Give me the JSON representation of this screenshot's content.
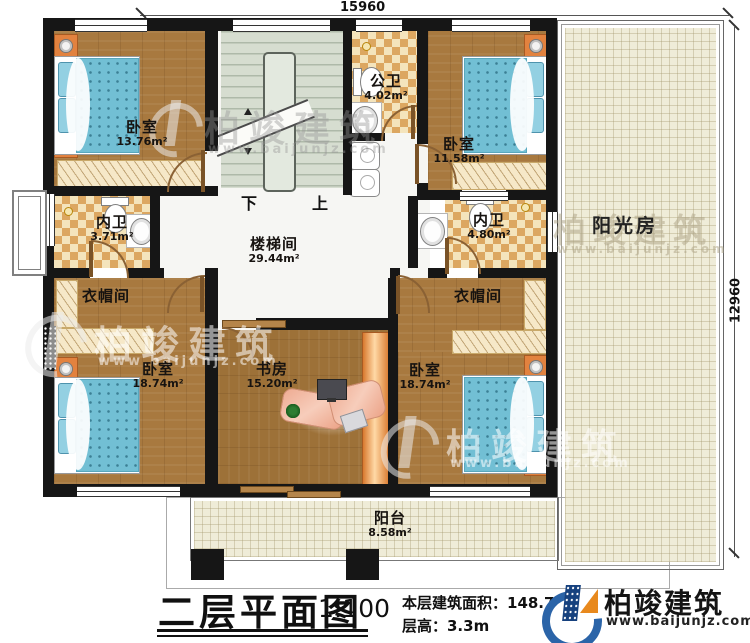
{
  "dimensions": {
    "width": "15960",
    "height": "12960"
  },
  "rooms": {
    "bedroom_tl": {
      "name": "卧室",
      "area": "13.76m²"
    },
    "stairwell": {
      "name": "楼梯间",
      "area": "29.44m²"
    },
    "public_bath": {
      "name": "公卫",
      "area": "4.02m²"
    },
    "bedroom_tr": {
      "name": "卧室",
      "area": "11.58m²"
    },
    "bath_left": {
      "name": "内卫",
      "area": "3.71m²"
    },
    "bath_right": {
      "name": "内卫",
      "area": "4.80m²"
    },
    "cloakroom_left": {
      "name": "衣帽间"
    },
    "cloakroom_right": {
      "name": "衣帽间"
    },
    "sunroom": {
      "name": "阳光房"
    },
    "bedroom_bl": {
      "name": "卧室",
      "area": "18.74m²"
    },
    "study": {
      "name": "书房",
      "area": "15.20m²"
    },
    "bedroom_br": {
      "name": "卧室",
      "area": "18.74m²"
    },
    "balcony": {
      "name": "阳台",
      "area": "8.58m²"
    }
  },
  "stairs": {
    "down_label": "下",
    "up_label": "上"
  },
  "title": {
    "name": "二层平面图",
    "scale": "1:100"
  },
  "info": {
    "building_area": "本层建筑面积：148.7",
    "floor_height": "层高：3.3m"
  },
  "logo": {
    "name": "柏竣建筑",
    "website": "www.baijunjz.com"
  },
  "watermark": {
    "brand": "柏竣建筑",
    "website": "www.baijunjz.com"
  },
  "colors": {
    "wall": "#161616",
    "wood": "#a8793f",
    "tile_dark": "#dca761",
    "tile_light": "#f4e4bc",
    "bed": "#72bfd4",
    "stairs": "#d6ddd0",
    "outdoor": "#efecd8",
    "logo_blue": "#2b64a8",
    "logo_orange": "#e8891d"
  }
}
